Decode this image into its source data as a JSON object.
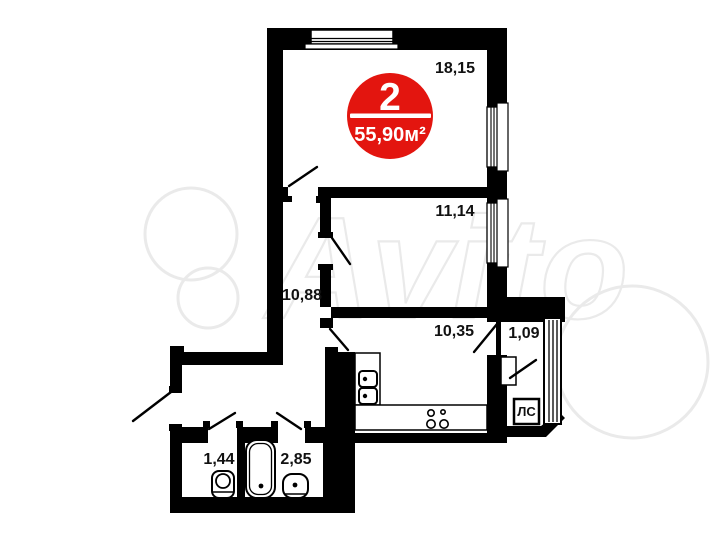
{
  "plan": {
    "type_badge": {
      "rooms": "2",
      "area": "55,90м²"
    },
    "rooms": [
      {
        "area": "18,15"
      },
      {
        "area": "11,14"
      },
      {
        "area": "10,88"
      },
      {
        "area": "10,35"
      },
      {
        "area": "1,09"
      },
      {
        "area": "1,44"
      },
      {
        "area": "2,85"
      }
    ],
    "stair_label": "ЛС"
  },
  "watermark": {
    "text": "Avito"
  },
  "colors": {
    "wall": "#000000",
    "badge_red": "#e3150f",
    "watermark": "#eaeaea",
    "background": "#ffffff"
  }
}
